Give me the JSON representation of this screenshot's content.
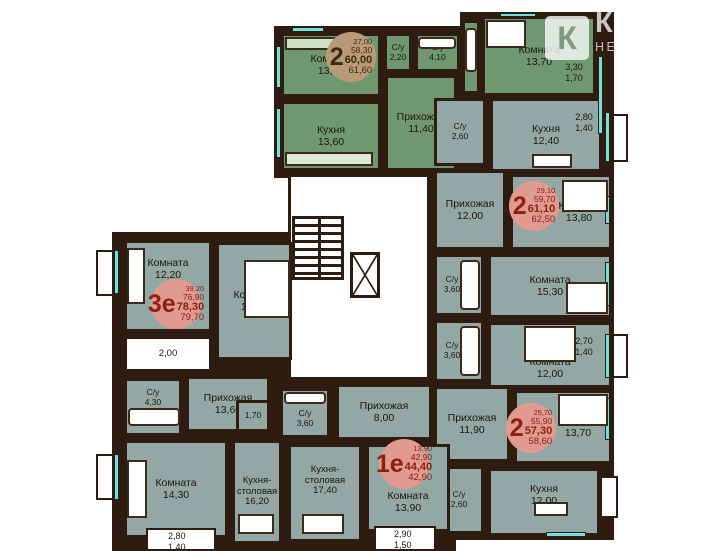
{
  "watermark": {
    "logo": "К",
    "line1": "КРЕАЛТ",
    "line2": "НЕДВИЖИМОСТЬ"
  },
  "palette": {
    "wall": "#2e1c10",
    "green_unit": "#6f9770",
    "gray_unit": "#93a7a4",
    "window_cyan": "#6fe2df",
    "badge_pink": "#e09a8f",
    "badge_tan": "#b99a77",
    "badge_text": "#8c2012"
  },
  "units": [
    {
      "type": "2",
      "stats": [
        "27,00",
        "58,30",
        "60,00",
        "61,60"
      ]
    },
    {
      "type": "2",
      "stats": [
        "29,10",
        "59,70",
        "61,10",
        "62,50"
      ]
    },
    {
      "type": "2",
      "stats": [
        "25,70",
        "55,90",
        "57,30",
        "58,60"
      ]
    },
    {
      "type": "3е",
      "stats": [
        "39,20",
        "76,90",
        "78,30",
        "79,70"
      ]
    },
    {
      "type": "1е",
      "stats": [
        "13,90",
        "42,90",
        "44,40",
        "42,90"
      ]
    }
  ],
  "rooms": [
    {
      "name": "Комната",
      "area": "13,30"
    },
    {
      "name": "Кухня",
      "area": "13,60"
    },
    {
      "name": "Прихожая",
      "area": "11,40"
    },
    {
      "name": "С/у",
      "area": "2,20"
    },
    {
      "name": "С/у",
      "area": "4,10"
    },
    {
      "name": "Комната",
      "area": "13,70"
    },
    {
      "name": "С/у",
      "area": "2,60"
    },
    {
      "name": "Кухня",
      "area": "12,40"
    },
    {
      "name": "Прихожая",
      "area": "12,00"
    },
    {
      "name": "Комната",
      "area": "13,80"
    },
    {
      "name": "Комната",
      "area": "15,30"
    },
    {
      "name": "С/у",
      "area": "3,60"
    },
    {
      "name": "С/у",
      "area": "3,60"
    },
    {
      "name": "Комната",
      "area": "12,00"
    },
    {
      "name": "Прихожая",
      "area": "11,90"
    },
    {
      "name": "Комната",
      "area": "13,70"
    },
    {
      "name": "Кухня",
      "area": "12,00"
    },
    {
      "name": "С/у",
      "area": "2,60"
    },
    {
      "name": "Комната",
      "area": "12,20"
    },
    {
      "name": "Комната",
      "area": "12,70"
    },
    {
      "name": "",
      "area": "2,00"
    },
    {
      "name": "Прихожая",
      "area": "13,60"
    },
    {
      "name": "С/у",
      "area": "4,30"
    },
    {
      "name": "",
      "area": "1,70"
    },
    {
      "name": "Комната",
      "area": "14,30"
    },
    {
      "name": "Кухня-столовая",
      "area": "16,20"
    },
    {
      "name": "С/у",
      "area": "3,60"
    },
    {
      "name": "Прихожая",
      "area": "8,00"
    },
    {
      "name": "Кухня-столовая",
      "area": "17,40"
    },
    {
      "name": "Комната",
      "area": "13,90"
    }
  ],
  "balconies": [
    {
      "l1": "3,30",
      "l2": "1,70"
    },
    {
      "l1": "2,80",
      "l2": "1,40"
    },
    {
      "l1": "2,70",
      "l2": "1,40"
    },
    {
      "l1": "2,80",
      "l2": "1,40"
    },
    {
      "l1": "2,90",
      "l2": "1,50"
    }
  ]
}
